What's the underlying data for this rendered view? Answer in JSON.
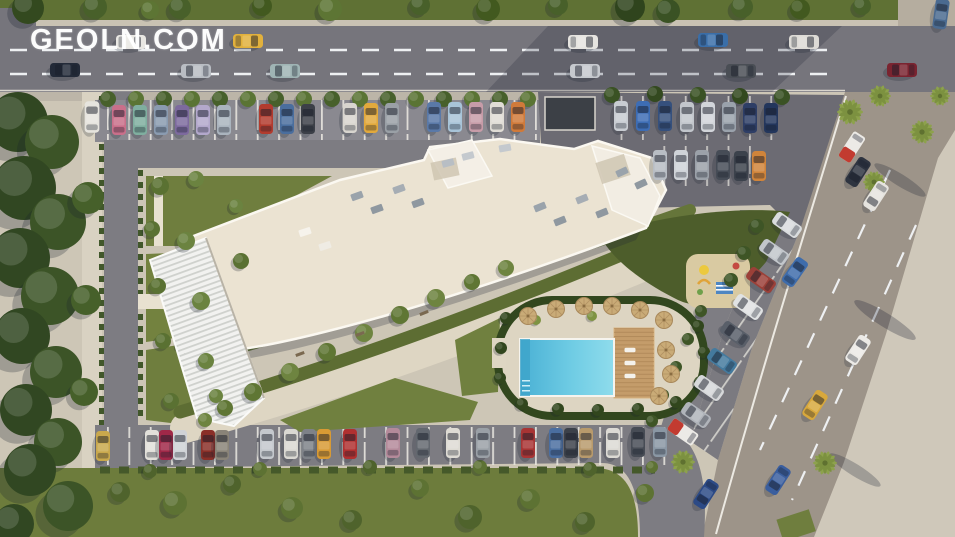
{
  "watermark": {
    "text": "GEOLN.COM",
    "color": "#ffffff"
  },
  "palette": {
    "road": "#76757c",
    "road_light": "#9d9489",
    "lot_shadow": "#6c6b73",
    "sidewalk": "#d6cfc0",
    "walkway": "#ded6c3",
    "site_base": "#cdc6b6",
    "roof": "#ebe3d2",
    "roof_edge": "#fbf8f1",
    "grass": "#6f7e3e",
    "grass_dark": "#4d5d2b",
    "tree_dark": "#33491f",
    "hedge": "#32471e",
    "pool_water": "#49b0d4",
    "pool_light": "#8fdcec",
    "deck_wood": "#c49c6a",
    "umbrella": "#c9ab77",
    "lane_mark": "#eef0f2"
  },
  "scene": {
    "description": "Aerial 3D render of a curved residential complex with rooftop, gardens, swimming pool, playground, tree-lined streets and parking rows",
    "cars": [
      [
        131,
        42,
        90,
        "#e9e7e3"
      ],
      [
        248,
        41,
        90,
        "#e2b13c"
      ],
      [
        583,
        42,
        90,
        "#e6e4e0"
      ],
      [
        713,
        40,
        90,
        "#3a6ea8"
      ],
      [
        804,
        42,
        90,
        "#dddbd6"
      ],
      [
        941,
        14,
        8,
        "#4a6a90"
      ],
      [
        65,
        70,
        -90,
        "#232a38"
      ],
      [
        196,
        71,
        -90,
        "#b9bdc3"
      ],
      [
        285,
        71,
        -90,
        "#9fb4b4"
      ],
      [
        585,
        71,
        -90,
        "#c6c9ce"
      ],
      [
        741,
        71,
        -90,
        "#4a4e55"
      ],
      [
        902,
        70,
        -90,
        "#7a2430"
      ],
      [
        119,
        120,
        0,
        "#c96f8a"
      ],
      [
        140,
        120,
        0,
        "#7fae9f"
      ],
      [
        161,
        120,
        0,
        "#8a9bb0"
      ],
      [
        182,
        120,
        0,
        "#7d6a9e"
      ],
      [
        203,
        120,
        0,
        "#b3a8cc"
      ],
      [
        224,
        120,
        0,
        "#aab4be"
      ],
      [
        266,
        119,
        0,
        "#b23b2e"
      ],
      [
        287,
        119,
        0,
        "#4a6e9e"
      ],
      [
        308,
        119,
        0,
        "#3c4048"
      ],
      [
        350,
        118,
        0,
        "#d8d5cf"
      ],
      [
        371,
        118,
        0,
        "#e2a93c"
      ],
      [
        392,
        118,
        0,
        "#9aa0a6"
      ],
      [
        434,
        117,
        0,
        "#5a79a8"
      ],
      [
        455,
        117,
        0,
        "#a8c4d8"
      ],
      [
        476,
        117,
        0,
        "#c79ca8"
      ],
      [
        497,
        117,
        0,
        "#e0ddd6"
      ],
      [
        518,
        117,
        0,
        "#d07a3a"
      ],
      [
        92,
        117,
        0,
        "#e6e4de",
        1.05
      ],
      [
        621,
        116,
        0,
        "#c8ccd2"
      ],
      [
        643,
        116,
        0,
        "#3d6db5"
      ],
      [
        665,
        116,
        0,
        "#35507d"
      ],
      [
        687,
        117,
        0,
        "#c2c6cc"
      ],
      [
        708,
        117,
        0,
        "#d2d5da"
      ],
      [
        729,
        117,
        0,
        "#9aa2ac"
      ],
      [
        750,
        118,
        0,
        "#2e3e66"
      ],
      [
        771,
        118,
        0,
        "#23365c"
      ],
      [
        660,
        165,
        0,
        "#b8bdc4"
      ],
      [
        681,
        165,
        0,
        "#cfd3d8"
      ],
      [
        702,
        165,
        0,
        "#9ba1a9"
      ],
      [
        723,
        165,
        0,
        "#464c56"
      ],
      [
        741,
        166,
        0,
        "#3c424c"
      ],
      [
        759,
        166,
        0,
        "#d0843a"
      ],
      [
        103,
        446,
        0,
        "#c9a84c"
      ],
      [
        152,
        445,
        0,
        "#e2e0da"
      ],
      [
        166,
        445,
        0,
        "#a02848"
      ],
      [
        180,
        445,
        0,
        "#cfd2d6"
      ],
      [
        208,
        445,
        0,
        "#8a2f28"
      ],
      [
        222,
        445,
        0,
        "#8a8478"
      ],
      [
        267,
        444,
        0,
        "#c4c8cd"
      ],
      [
        291,
        444,
        0,
        "#dad8d2"
      ],
      [
        309,
        444,
        0,
        "#7e8288"
      ],
      [
        324,
        444,
        0,
        "#d89a34"
      ],
      [
        350,
        444,
        0,
        "#b03030"
      ],
      [
        393,
        443,
        0,
        "#b48a9a"
      ],
      [
        423,
        443,
        0,
        "#63686f"
      ],
      [
        453,
        443,
        0,
        "#dedbd4"
      ],
      [
        483,
        443,
        0,
        "#9aa0a6"
      ],
      [
        528,
        443,
        0,
        "#a83434"
      ],
      [
        556,
        443,
        0,
        "#4a6ea0"
      ],
      [
        571,
        443,
        0,
        "#3c414a"
      ],
      [
        586,
        443,
        0,
        "#b89a6c"
      ],
      [
        613,
        443,
        0,
        "#dcdad4"
      ],
      [
        638,
        442,
        0,
        "#474c55"
      ],
      [
        660,
        442,
        0,
        "#8a97a4"
      ],
      [
        858,
        172,
        213,
        "#2e3440"
      ],
      [
        876,
        196,
        213,
        "#e6e4df"
      ],
      [
        858,
        350,
        33,
        "#eceae6"
      ],
      [
        815,
        405,
        33,
        "#d8a83c"
      ],
      [
        778,
        480,
        213,
        "#3a5e9e"
      ],
      [
        706,
        494,
        213,
        "#2c4a86"
      ],
      [
        787,
        225,
        -55,
        "#d9dcde"
      ],
      [
        774,
        252,
        -55,
        "#c2c6cb"
      ],
      [
        761,
        280,
        -55,
        "#9b4038"
      ],
      [
        748,
        307,
        -55,
        "#e0e2e3"
      ],
      [
        735,
        334,
        -55,
        "#595f69"
      ],
      [
        722,
        361,
        -55,
        "#447a9e"
      ],
      [
        709,
        388,
        -55,
        "#d6d8da"
      ],
      [
        696,
        415,
        -55,
        "#b0b4ba"
      ],
      [
        795,
        272,
        35,
        "#3e6cab"
      ]
    ],
    "buses": [
      [
        852,
        147,
        213
      ],
      [
        683,
        432,
        -55
      ]
    ],
    "trees": [
      [
        18,
        122,
        30,
        "#314722"
      ],
      [
        52,
        142,
        27,
        "#3c5427"
      ],
      [
        24,
        188,
        32,
        "#314722"
      ],
      [
        58,
        222,
        28,
        "#3c5427"
      ],
      [
        20,
        258,
        30,
        "#314722"
      ],
      [
        50,
        296,
        29,
        "#3c5427"
      ],
      [
        22,
        336,
        28,
        "#314722"
      ],
      [
        56,
        372,
        26,
        "#3c5427"
      ],
      [
        26,
        410,
        26,
        "#314722"
      ],
      [
        58,
        442,
        24,
        "#3c5427"
      ],
      [
        88,
        198,
        16,
        "#46602a"
      ],
      [
        86,
        300,
        15,
        "#46602a"
      ],
      [
        84,
        392,
        14,
        "#46602a"
      ],
      [
        30,
        470,
        26,
        "#314722"
      ],
      [
        68,
        506,
        25,
        "#3c5427"
      ],
      [
        14,
        524,
        20,
        "#314722"
      ],
      [
        28,
        8,
        16,
        "#33491f"
      ],
      [
        95,
        7,
        12,
        "#48602a"
      ],
      [
        150,
        10,
        9,
        "#5d7534"
      ],
      [
        180,
        8,
        11,
        "#48602a"
      ],
      [
        262,
        6,
        10,
        "#42591f"
      ],
      [
        330,
        9,
        12,
        "#5d7534"
      ],
      [
        420,
        5,
        10,
        "#48602a"
      ],
      [
        488,
        9,
        12,
        "#42591f"
      ],
      [
        558,
        5,
        10,
        "#48602a"
      ],
      [
        630,
        7,
        15,
        "#2f441d"
      ],
      [
        668,
        11,
        12,
        "#3a5224"
      ],
      [
        742,
        7,
        11,
        "#48602a"
      ],
      [
        800,
        9,
        10,
        "#42591f"
      ],
      [
        862,
        6,
        9,
        "#48602a"
      ],
      [
        108,
        99,
        8,
        "#47602b"
      ],
      [
        136,
        99,
        8,
        "#5a7434"
      ],
      [
        164,
        99,
        8,
        "#47602b"
      ],
      [
        192,
        99,
        8,
        "#5a7434"
      ],
      [
        220,
        99,
        8,
        "#47602b"
      ],
      [
        248,
        99,
        8,
        "#5a7434"
      ],
      [
        276,
        99,
        8,
        "#47602b"
      ],
      [
        304,
        99,
        8,
        "#5a7434"
      ],
      [
        332,
        99,
        8,
        "#47602b"
      ],
      [
        360,
        99,
        8,
        "#5a7434"
      ],
      [
        388,
        99,
        8,
        "#47602b"
      ],
      [
        416,
        99,
        8,
        "#5a7434"
      ],
      [
        444,
        99,
        8,
        "#47602b"
      ],
      [
        472,
        99,
        8,
        "#5a7434"
      ],
      [
        500,
        99,
        8,
        "#47602b"
      ],
      [
        528,
        99,
        8,
        "#5a7434"
      ],
      [
        612,
        95,
        8,
        "#3a5224"
      ],
      [
        655,
        94,
        8,
        "#33491f"
      ],
      [
        698,
        95,
        8,
        "#3a5224"
      ],
      [
        740,
        96,
        8,
        "#33491f"
      ],
      [
        782,
        97,
        8,
        "#3a5224"
      ],
      [
        160,
        186,
        9,
        "#5a7132"
      ],
      [
        196,
        179,
        8,
        "#6b8340"
      ],
      [
        152,
        229,
        8,
        "#5a7132"
      ],
      [
        186,
        241,
        9,
        "#6b8340"
      ],
      [
        158,
        286,
        8,
        "#5a7132"
      ],
      [
        201,
        301,
        9,
        "#6b8340"
      ],
      [
        163,
        341,
        8,
        "#5a7132"
      ],
      [
        206,
        361,
        8,
        "#6b8340"
      ],
      [
        171,
        401,
        8,
        "#5a7132"
      ],
      [
        216,
        396,
        7,
        "#6b8340"
      ],
      [
        241,
        261,
        8,
        "#5a7132"
      ],
      [
        236,
        206,
        7,
        "#6b8340"
      ],
      [
        225,
        408,
        8,
        "#5f7634"
      ],
      [
        205,
        420,
        7,
        "#6e8440"
      ],
      [
        253,
        392,
        9,
        "#5f7634"
      ],
      [
        290,
        372,
        9,
        "#6e8440"
      ],
      [
        327,
        352,
        9,
        "#5f7634"
      ],
      [
        364,
        333,
        9,
        "#6e8440"
      ],
      [
        400,
        315,
        9,
        "#5f7634"
      ],
      [
        436,
        298,
        9,
        "#6e8440"
      ],
      [
        472,
        282,
        8,
        "#5f7634"
      ],
      [
        506,
        268,
        8,
        "#6e8440"
      ],
      [
        506,
        318,
        6,
        "#31461d"
      ],
      [
        501,
        348,
        6,
        "#31461d"
      ],
      [
        500,
        378,
        6,
        "#31461d"
      ],
      [
        522,
        404,
        6,
        "#31461d"
      ],
      [
        558,
        409,
        6,
        "#31461d"
      ],
      [
        598,
        410,
        6,
        "#31461d"
      ],
      [
        638,
        409,
        6,
        "#31461d"
      ],
      [
        676,
        402,
        6,
        "#31461d"
      ],
      [
        700,
        382,
        6,
        "#31461d"
      ],
      [
        704,
        352,
        6,
        "#31461d"
      ],
      [
        698,
        326,
        6,
        "#31461d"
      ],
      [
        536,
        320,
        5,
        "#7e9342"
      ],
      [
        592,
        316,
        5,
        "#7e9342"
      ],
      [
        757,
        226,
        7,
        "#3e5526"
      ],
      [
        744,
        253,
        7,
        "#3e5526"
      ],
      [
        731,
        280,
        7,
        "#3e5526"
      ],
      [
        701,
        311,
        6,
        "#3e5526"
      ],
      [
        688,
        339,
        6,
        "#3e5526"
      ],
      [
        676,
        367,
        6,
        "#3e5526"
      ],
      [
        663,
        395,
        6,
        "#3e5526"
      ],
      [
        652,
        421,
        6,
        "#3e5526"
      ],
      [
        120,
        492,
        10,
        "#4f632c"
      ],
      [
        175,
        503,
        12,
        "#5d7233"
      ],
      [
        232,
        484,
        9,
        "#4f632c"
      ],
      [
        292,
        508,
        11,
        "#5d7233"
      ],
      [
        352,
        520,
        10,
        "#4f632c"
      ],
      [
        420,
        488,
        9,
        "#5d7233"
      ],
      [
        470,
        517,
        12,
        "#4f632c"
      ],
      [
        530,
        499,
        10,
        "#5d7233"
      ],
      [
        585,
        522,
        10,
        "#4f632c"
      ],
      [
        645,
        493,
        9,
        "#5d7233"
      ],
      [
        150,
        471,
        7,
        "#4f632c"
      ],
      [
        260,
        469,
        7,
        "#5d7233"
      ],
      [
        370,
        467,
        7,
        "#4f632c"
      ],
      [
        480,
        467,
        7,
        "#5d7233"
      ],
      [
        590,
        469,
        7,
        "#4f632c"
      ],
      [
        652,
        467,
        6,
        "#5d7233"
      ]
    ],
    "palms": [
      [
        850,
        112,
        1.3
      ],
      [
        922,
        132,
        1.2
      ],
      [
        874,
        182,
        1.1
      ],
      [
        940,
        96,
        1.0
      ],
      [
        880,
        96,
        1.1
      ],
      [
        825,
        463,
        1.2
      ],
      [
        683,
        462,
        1.2
      ]
    ],
    "umbrellas": [
      [
        528,
        316
      ],
      [
        556,
        309
      ],
      [
        584,
        306
      ],
      [
        612,
        306
      ],
      [
        640,
        310
      ],
      [
        664,
        320
      ],
      [
        666,
        350
      ],
      [
        671,
        374
      ],
      [
        659,
        396
      ]
    ],
    "loungers": [
      [
        630,
        350
      ],
      [
        630,
        363
      ],
      [
        630,
        376
      ]
    ],
    "benches": [
      [
        300,
        354,
        -20
      ],
      [
        360,
        334,
        -20
      ],
      [
        424,
        313,
        -22
      ]
    ],
    "roof_units": [
      [
        357,
        196,
        -20,
        "#9aa3ab"
      ],
      [
        377,
        209,
        -20,
        "#8f98a0"
      ],
      [
        399,
        189,
        -20,
        "#a6adb4"
      ],
      [
        418,
        203,
        -20,
        "#8f98a0"
      ],
      [
        540,
        207,
        -22,
        "#9aa3ab"
      ],
      [
        560,
        221,
        -22,
        "#8f98a0"
      ],
      [
        582,
        199,
        -22,
        "#a6adb4"
      ],
      [
        602,
        213,
        -22,
        "#8f98a0"
      ],
      [
        448,
        163,
        -15,
        "#b8bec4"
      ],
      [
        468,
        156,
        -15,
        "#c4c9ce"
      ],
      [
        622,
        172,
        -25,
        "#9aa3ab"
      ],
      [
        641,
        184,
        -25,
        "#8f98a0"
      ],
      [
        305,
        232,
        -18,
        "#f6f3ec"
      ],
      [
        325,
        246,
        -18,
        "#efece4"
      ],
      [
        505,
        148,
        -10,
        "#c4c9ce"
      ]
    ]
  }
}
